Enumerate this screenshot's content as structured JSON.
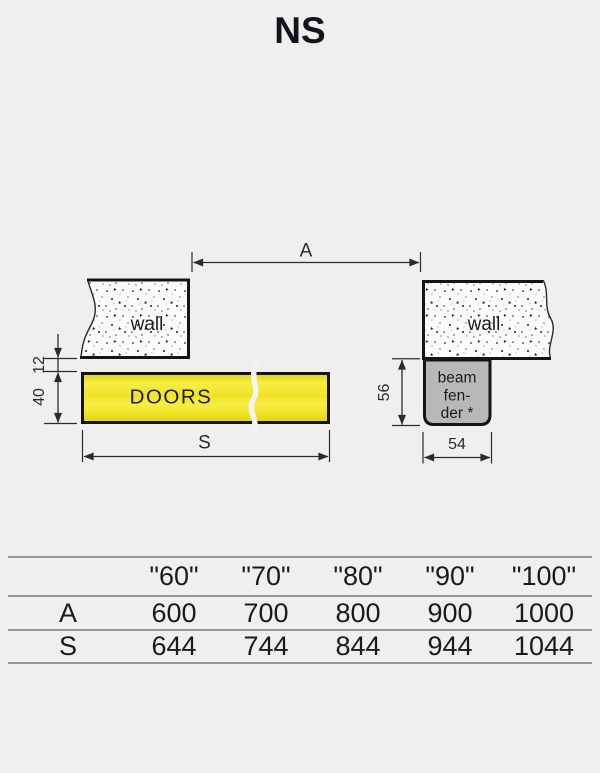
{
  "title": "NS",
  "diagram": {
    "dim_a_label": "A",
    "dim_s_label": "S",
    "dim_12": "12",
    "dim_40": "40",
    "dim_56": "56",
    "dim_54": "54",
    "wall_left_label": "wall",
    "wall_right_label": "wall",
    "doors_label": "DOORS",
    "beam_fender_lines": [
      "beam",
      "fen-",
      "der *"
    ],
    "colors": {
      "background": "#f0efed",
      "doors_yellow": "#f0e326",
      "doors_yellow_light": "#f7ee44",
      "doors_yellow_dark": "#e0d214",
      "beam_fender_gray": "#b8b8b6",
      "wall_fill": "#fbfbf9",
      "outline_black": "#141414",
      "dim_line": "#2b2b2b",
      "table_line": "#979797"
    }
  },
  "table": {
    "columns": [
      "\"60\"",
      "\"70\"",
      "\"80\"",
      "\"90\"",
      "\"100\""
    ],
    "rows": [
      {
        "label": "A",
        "values": [
          "600",
          "700",
          "800",
          "900",
          "1000"
        ]
      },
      {
        "label": "S",
        "values": [
          "644",
          "744",
          "844",
          "944",
          "1044"
        ]
      }
    ]
  }
}
